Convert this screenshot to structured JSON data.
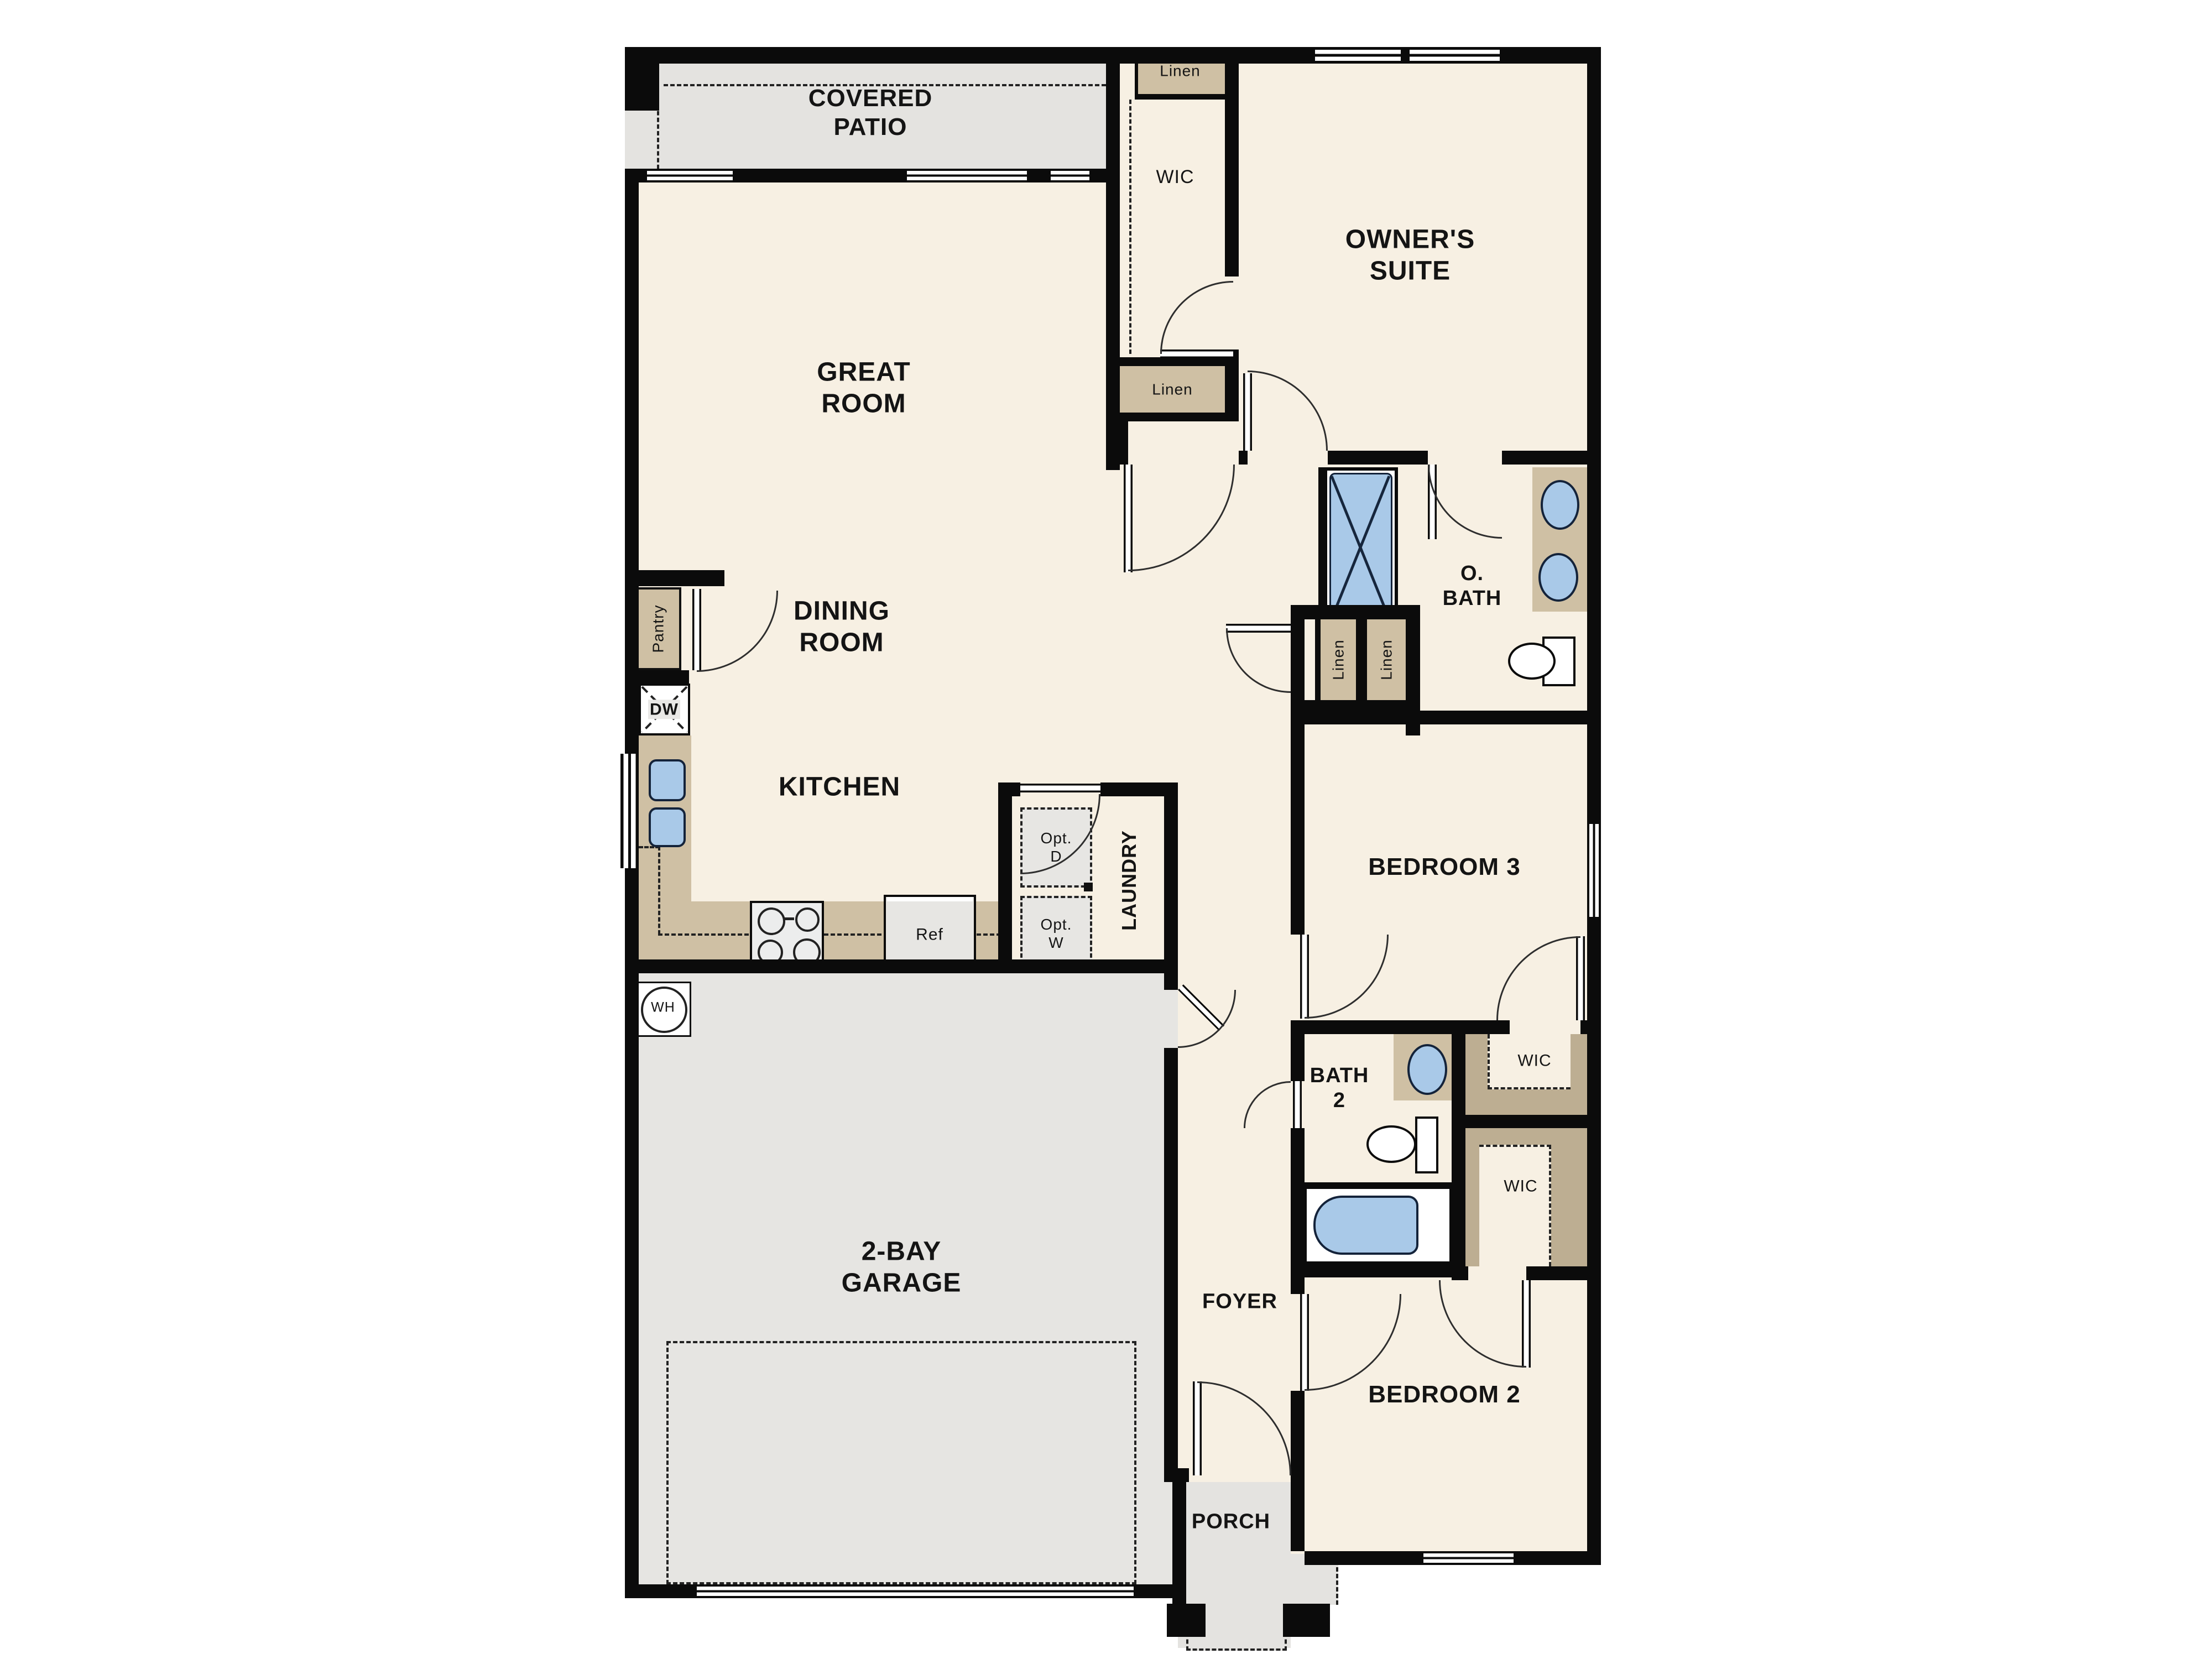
{
  "title": "Single-story floor plan",
  "colors": {
    "wall": "#0b0b0b",
    "floor": "#f7f0e3",
    "patio_gray": "#e4e3e0",
    "garage_gray": "#e6e5e2",
    "cabinet_tan": "#cfc0a4",
    "shelf_tan": "#bdae92",
    "fixture_blue": "#a9c9e8",
    "appliance_gray": "#e7e6e3"
  },
  "labels": {
    "covered_patio": "COVERED\nPATIO",
    "great_room": "GREAT\nROOM",
    "dining_room": "DINING\nROOM",
    "kitchen": "KITCHEN",
    "owners_suite": "OWNER'S\nSUITE",
    "o_bath": "O.\nBATH",
    "bedroom_3": "BEDROOM 3",
    "bedroom_2": "BEDROOM 2",
    "bath_2": "BATH\n2",
    "foyer": "FOYER",
    "porch": "PORCH",
    "garage": "2-BAY\nGARAGE",
    "laundry": "LAUNDRY",
    "wic_hall": "WIC",
    "wic_bedroom3": "WIC",
    "wic_bedroom2": "WIC",
    "linen_top": "Linen",
    "linen_mid": "Linen",
    "linen_left": "Linen",
    "linen_right": "Linen",
    "pantry": "Pantry",
    "dishwasher": "DW",
    "refrigerator": "Ref",
    "water_heater": "WH",
    "opt_dryer": "Opt.\nD",
    "opt_washer": "Opt.\nW"
  }
}
